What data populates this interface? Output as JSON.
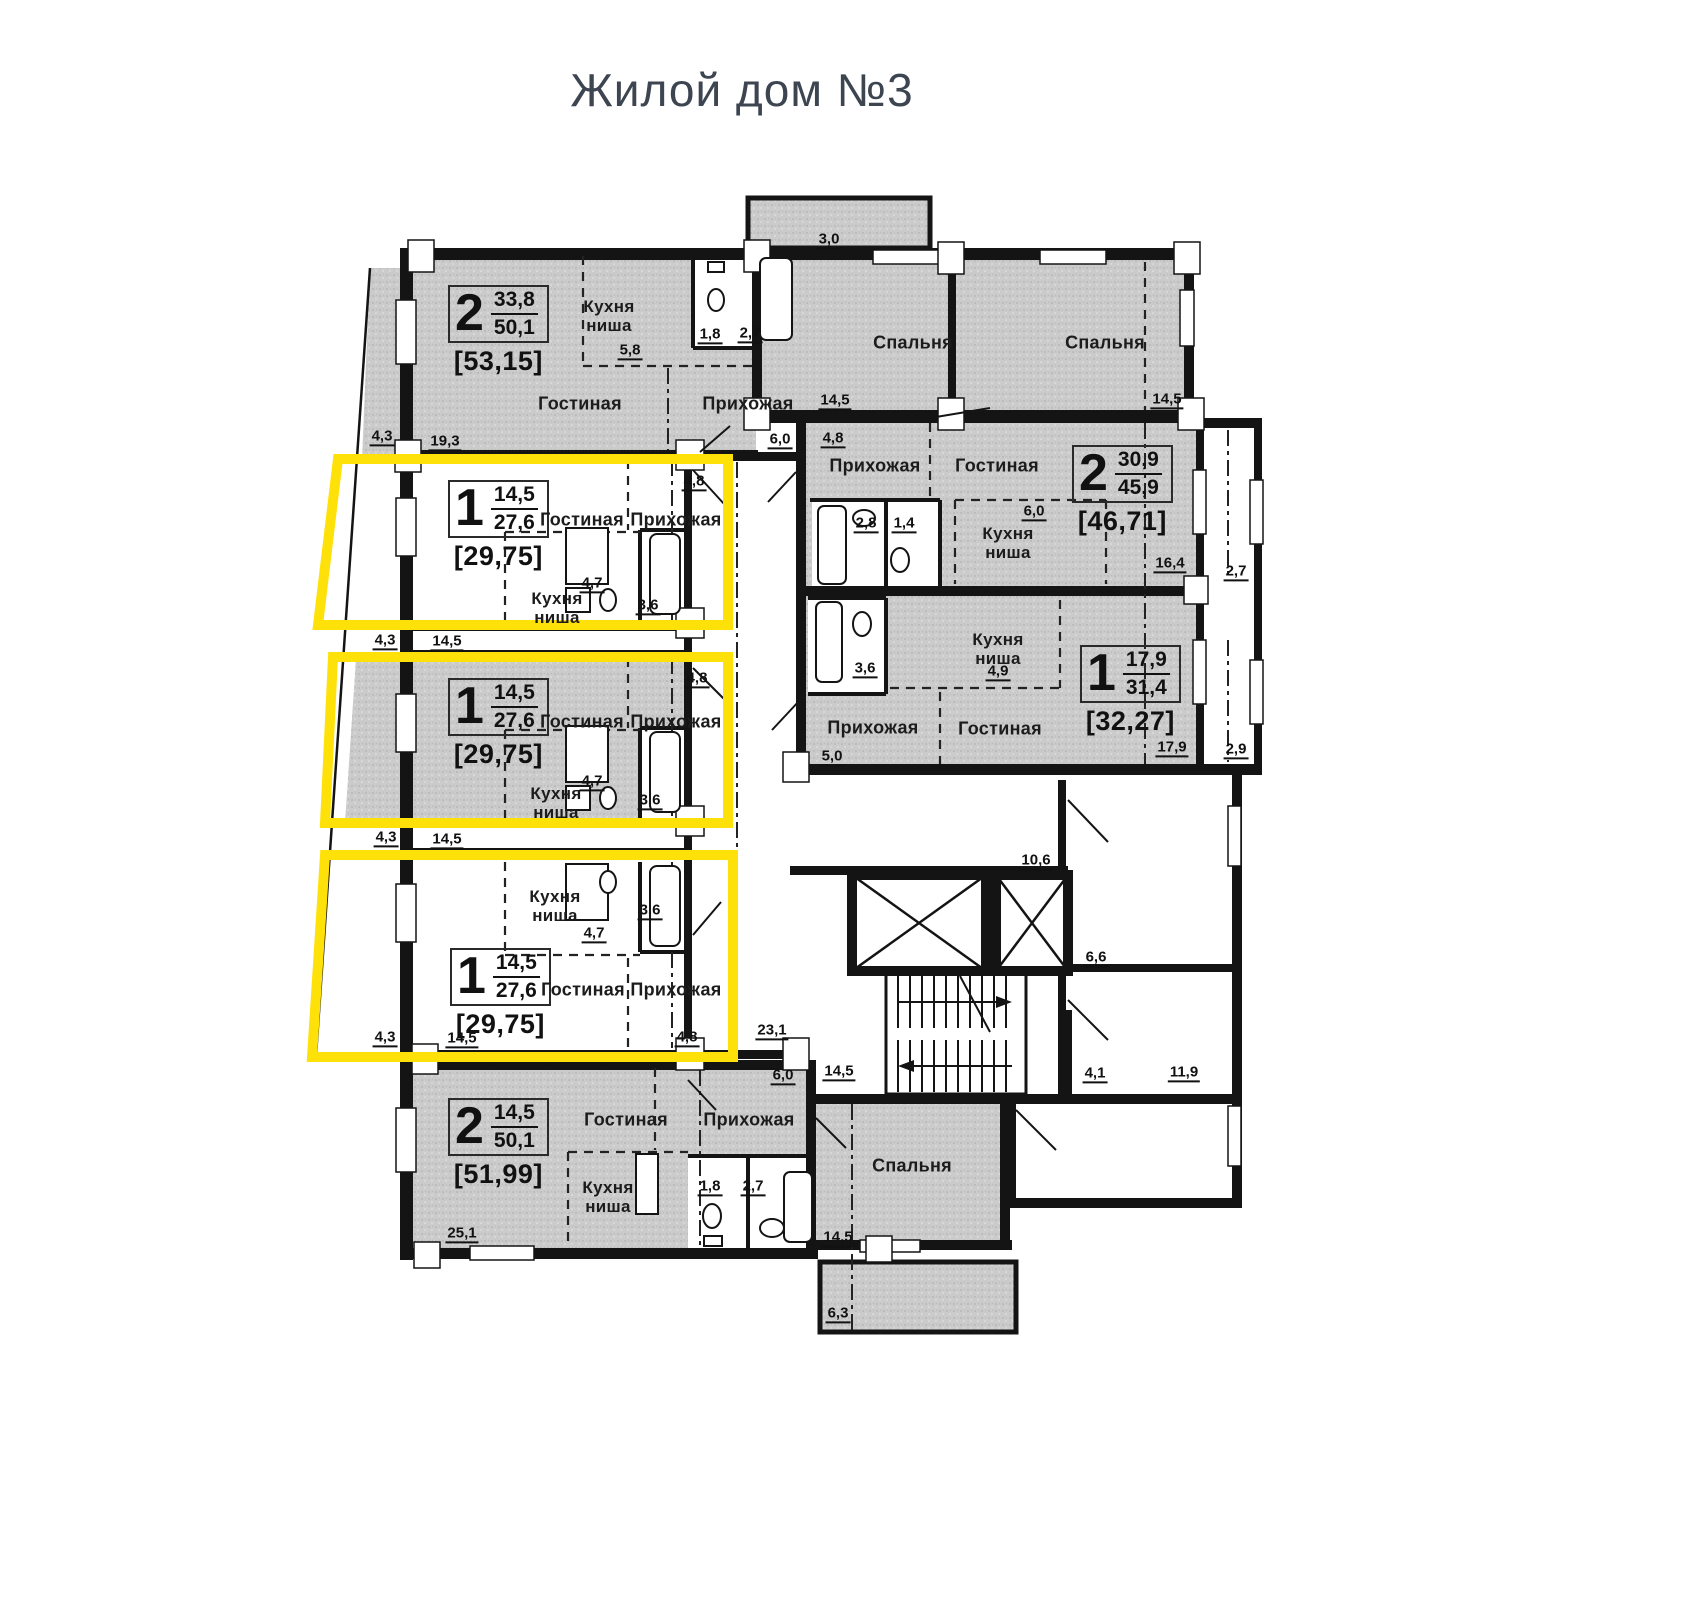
{
  "title": "Жилой дом №3",
  "colors": {
    "highlight": "#ffe10a",
    "wall": "#141414",
    "room_fill": "#cbcbcb"
  },
  "rooms": {
    "living": "Гостиная",
    "hall": "Прихожая",
    "kitchen": "Кухня ниша",
    "bedroom": "Спальня"
  },
  "stamps": [
    {
      "rooms": "2",
      "upper": "33,8",
      "lower": "50,1",
      "total": "[53,15]"
    },
    {
      "rooms": "1",
      "upper": "14,5",
      "lower": "27,6",
      "total": "[29,75]"
    },
    {
      "rooms": "1",
      "upper": "14,5",
      "lower": "27,6",
      "total": "[29,75]"
    },
    {
      "rooms": "1",
      "upper": "14,5",
      "lower": "27,6",
      "total": "[29,75]"
    },
    {
      "rooms": "2",
      "upper": "14,5",
      "lower": "50,1",
      "total": "[51,99]"
    },
    {
      "rooms": "2",
      "upper": "30,9",
      "lower": "45,9",
      "total": "[46,71]"
    },
    {
      "rooms": "1",
      "upper": "17,9",
      "lower": "31,4",
      "total": "[32,27]"
    }
  ],
  "dims": {
    "v3_0": "3,0",
    "v4_3": "4,3",
    "v19_3": "19,3",
    "v14_5": "14,5",
    "v25_1": "25,1",
    "v5_8": "5,8",
    "v1_8": "1,8",
    "v2_7": "2,7",
    "v6_0": "6,0",
    "v4_8": "4,8",
    "v2_8": "2,8",
    "v1_4": "1,4",
    "v16_4": "16,4",
    "v4_7": "4,7",
    "v3_6": "3,6",
    "v4_9": "4,9",
    "v5_0": "5,0",
    "v17_9": "17,9",
    "v2_9": "2,9",
    "v10_6": "10,6",
    "v6_6": "6,6",
    "v23_1": "23,1",
    "v4_1": "4,1",
    "v11_9": "11,9",
    "v6_3": "6,3"
  }
}
